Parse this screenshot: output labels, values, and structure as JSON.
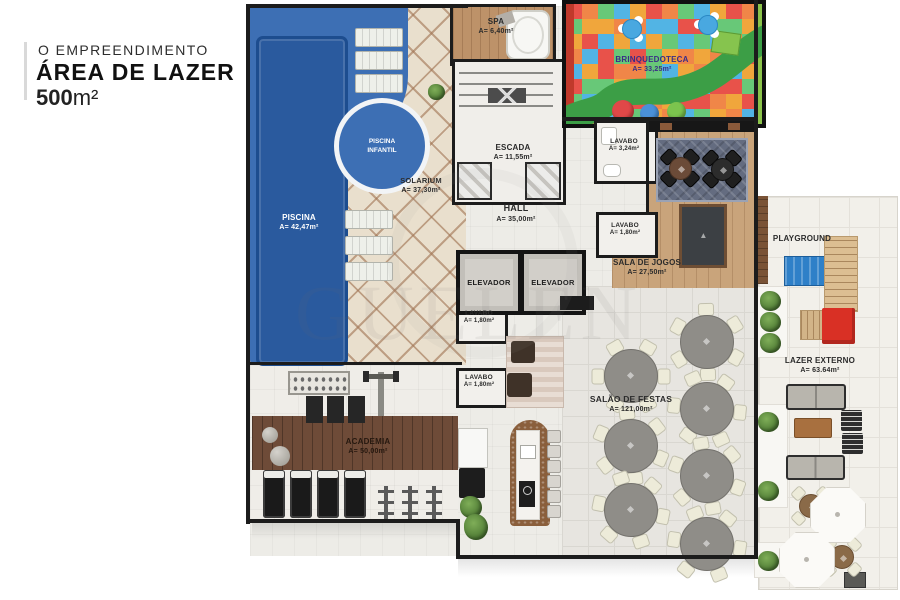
{
  "title": {
    "kicker": "O EMPREENDIMENTO",
    "main": "ÁREA DE LAZER",
    "area_number": "500",
    "area_unit": "m²"
  },
  "watermark": "GUELEN",
  "rooms": {
    "piscina": {
      "name": "PISCINA",
      "area": "A= 42,47m²"
    },
    "piscina_infantil": {
      "line1": "PISCINA",
      "line2": "INFANTIL"
    },
    "solarium": {
      "name": "SOLARIUM",
      "area": "A= 37,30m²"
    },
    "spa": {
      "name": "SPA",
      "area": "A= 6,40m²"
    },
    "escada": {
      "name": "ESCADA",
      "area": "A= 11,55m²"
    },
    "brinquedoteca": {
      "name": "BRINQUEDOTECA",
      "area": "A= 33,25m²"
    },
    "lavabo_spa": {
      "name": "LAVABO",
      "area": "A= 3,24m²"
    },
    "hall": {
      "name": "HALL",
      "area": "A= 35,00m²"
    },
    "elevador_1": {
      "name": "ELEVADOR"
    },
    "elevador_2": {
      "name": "ELEVADOR"
    },
    "lavabo_jogos": {
      "name": "LAVABO",
      "area": "A= 1,80m²"
    },
    "lavabo_hall_1": {
      "name": "LAVABO",
      "area": "A= 1,80m²"
    },
    "lavabo_hall_2": {
      "name": "LAVABO",
      "area": "A= 1,80m²"
    },
    "sala_de_jogos": {
      "name": "SALA DE JOGOS",
      "area": "A= 27,50m²"
    },
    "salao_de_festas": {
      "name": "SALÃO DE FESTAS",
      "area": "A= 121,00m²"
    },
    "academia": {
      "name": "ACADEMIA",
      "area": "A= 50,00m²"
    },
    "playground": {
      "name": "PLAYGROUND"
    },
    "lazer_externo": {
      "name": "LAZER EXTERNO",
      "area": "A= 63.64m²"
    }
  },
  "colors": {
    "pool_deck": "#3d6fb4",
    "pool_water": "#2a5a9e",
    "wall": "#1c1c1c",
    "play_path": "#3c9e46",
    "play_palette": [
      "#e8524a",
      "#8bc34a",
      "#f0a63c",
      "#9e6cc8",
      "#52b4e4",
      "#e8d44c",
      "#68c878",
      "#e87ab0",
      "#f08648",
      "#6aaed6"
    ]
  }
}
